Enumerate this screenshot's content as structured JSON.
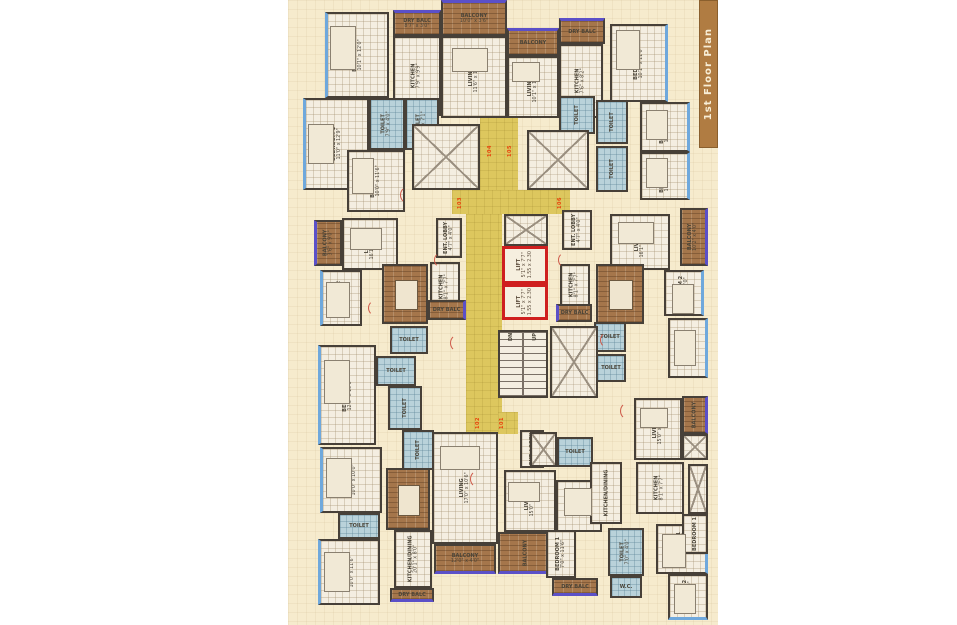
{
  "banner": {
    "title": "1st Floor Plan"
  },
  "colors": {
    "window": "#6fa8dc",
    "balcony_edge": "#5b50c8",
    "wall": "#474038",
    "lift_outline": "#cf1f1f",
    "unit_number": "#e8430c",
    "corridor": "#ddc75e",
    "plan_background": "#f6ebcd"
  },
  "areas": [
    {
      "kind": "yellow",
      "name": "corridor",
      "x": 480,
      "y": 114,
      "w": 38,
      "h": 84
    },
    {
      "kind": "yellow",
      "name": "corridor",
      "x": 452,
      "y": 190,
      "w": 118,
      "h": 24
    },
    {
      "kind": "yellow",
      "name": "corridor",
      "x": 466,
      "y": 214,
      "w": 36,
      "h": 218
    },
    {
      "kind": "yellow",
      "name": "corridor",
      "x": 498,
      "y": 412,
      "w": 20,
      "h": 22
    },
    {
      "kind": "room",
      "label": "BEDROOM 2",
      "dims": "10'1\" x 12'0\"",
      "rot": 1,
      "x": 325,
      "y": 12,
      "w": 64,
      "h": 86,
      "win": "l"
    },
    {
      "kind": "balcony",
      "label": "DRY BALC",
      "dims": "8'7\" x 3'0\"",
      "x": 393,
      "y": 10,
      "w": 48,
      "h": 26,
      "win": "t"
    },
    {
      "kind": "room",
      "label": "KITCHEN",
      "dims": "7'9\" x 9'9\"",
      "rot": 1,
      "x": 393,
      "y": 36,
      "w": 48,
      "h": 80
    },
    {
      "kind": "room",
      "label": "BEDROOM 1",
      "dims": "11'0\" x 12'9\"",
      "rot": 1,
      "x": 303,
      "y": 98,
      "w": 66,
      "h": 92,
      "win": "l"
    },
    {
      "kind": "toilet",
      "label": "TOILET",
      "dims": "7'9\" x 4'0\"",
      "rot": 1,
      "x": 369,
      "y": 98,
      "w": 36,
      "h": 52
    },
    {
      "kind": "toilet",
      "label": "TOILET",
      "dims": "4'0\" x 7'1\"",
      "rot": 1,
      "x": 405,
      "y": 98,
      "w": 34,
      "h": 52
    },
    {
      "kind": "room",
      "label": "BEDROOM 3",
      "dims": "10'0\" x 11'6\"",
      "rot": 1,
      "x": 347,
      "y": 150,
      "w": 58,
      "h": 62
    },
    {
      "kind": "balcony",
      "label": "BALCONY",
      "dims": "10'0\" x 3'6\"",
      "x": 441,
      "y": 0,
      "w": 66,
      "h": 36,
      "win": "t"
    },
    {
      "kind": "room",
      "label": "LIVING",
      "dims": "11'6\" x 11'0\"",
      "rot": 1,
      "x": 441,
      "y": 36,
      "w": 66,
      "h": 82
    },
    {
      "kind": "balcony",
      "label": "BALCONY",
      "x": 507,
      "y": 28,
      "w": 52,
      "h": 28,
      "win": "t"
    },
    {
      "kind": "room",
      "label": "LIVING",
      "dims": "10'1\" x 12'6\"",
      "rot": 1,
      "x": 507,
      "y": 56,
      "w": 52,
      "h": 62
    },
    {
      "kind": "balcony",
      "label": "DRY BALC",
      "x": 559,
      "y": 18,
      "w": 46,
      "h": 26,
      "win": "t"
    },
    {
      "kind": "room",
      "label": "KITCHEN",
      "dims": "7'6\" x 8'2\"",
      "rot": 1,
      "x": 559,
      "y": 44,
      "w": 44,
      "h": 74
    },
    {
      "kind": "room",
      "label": "BEDROOM 2",
      "dims": "10'1\" x 11'0\"",
      "rot": 1,
      "x": 610,
      "y": 24,
      "w": 58,
      "h": 78,
      "win": "r"
    },
    {
      "kind": "toilet",
      "label": "TOILET",
      "rot": 1,
      "x": 559,
      "y": 96,
      "w": 36,
      "h": 38
    },
    {
      "kind": "toilet",
      "label": "TOILET",
      "rot": 1,
      "x": 596,
      "y": 100,
      "w": 32,
      "h": 44
    },
    {
      "kind": "room",
      "label": "BEDROOM 1",
      "dims": "11'0\" x 10'1\"",
      "rot": 1,
      "x": 640,
      "y": 102,
      "w": 50,
      "h": 50,
      "win": "r"
    },
    {
      "kind": "toilet",
      "label": "TOILET",
      "rot": 1,
      "x": 596,
      "y": 146,
      "w": 32,
      "h": 46
    },
    {
      "kind": "room",
      "label": "BEDROOM 1",
      "dims": "11'6\" x 10'1\"",
      "rot": 1,
      "x": 640,
      "y": 152,
      "w": 50,
      "h": 48,
      "win": "r"
    },
    {
      "kind": "room",
      "label": "ENT. LOBBY",
      "dims": "4'7\" x 4'0\"",
      "rot": 1,
      "x": 562,
      "y": 210,
      "w": 30,
      "h": 40
    },
    {
      "kind": "room",
      "label": "LIVING",
      "dims": "16'1\" x 10'6\"",
      "rot": 1,
      "x": 610,
      "y": 214,
      "w": 60,
      "h": 56
    },
    {
      "kind": "balcony",
      "label": "BALCONY",
      "dims": "10'2\" x 4'0\"",
      "rot": 1,
      "x": 680,
      "y": 208,
      "w": 28,
      "h": 58,
      "win": "r"
    },
    {
      "kind": "room",
      "label": "KITCHEN",
      "dims": "8'1\" x 7'7\"",
      "rot": 1,
      "x": 560,
      "y": 264,
      "w": 30,
      "h": 42
    },
    {
      "kind": "dining",
      "label": "DINING",
      "dims": "8'0\" x 8'0\"",
      "rot": 1,
      "x": 596,
      "y": 264,
      "w": 48,
      "h": 60
    },
    {
      "kind": "room",
      "label": "BEDROOM 2",
      "dims": "10'1\" x 10'0\"",
      "rot": 1,
      "x": 664,
      "y": 270,
      "w": 40,
      "h": 46,
      "win": "r"
    },
    {
      "kind": "balcony",
      "label": "DRY BALC",
      "x": 556,
      "y": 304,
      "w": 36,
      "h": 18,
      "win": "l"
    },
    {
      "kind": "toilet",
      "label": "TOILET",
      "x": 594,
      "y": 322,
      "w": 32,
      "h": 30
    },
    {
      "kind": "room",
      "label": "BEDROOM 2",
      "dims": "11'6\" x 10'6\"",
      "rot": 1,
      "x": 668,
      "y": 318,
      "w": 40,
      "h": 60,
      "win": "r"
    },
    {
      "kind": "toilet",
      "label": "TOILET",
      "x": 596,
      "y": 354,
      "w": 30,
      "h": 28
    },
    {
      "kind": "balcony",
      "label": "BALCONY",
      "dims": "3'6\" x 9'0\"",
      "rot": 1,
      "x": 314,
      "y": 220,
      "w": 28,
      "h": 46,
      "win": "l"
    },
    {
      "kind": "room",
      "label": "LIVING",
      "dims": "16'1\" x 10'6\"",
      "rot": 1,
      "x": 342,
      "y": 218,
      "w": 56,
      "h": 52
    },
    {
      "kind": "room",
      "label": "ENT. LOBBY",
      "dims": "4'7\" x 4'0\"",
      "rot": 1,
      "x": 436,
      "y": 218,
      "w": 26,
      "h": 40
    },
    {
      "kind": "room",
      "label": "KITCHEN",
      "dims": "8'1\" x 7'7\"",
      "rot": 1,
      "x": 430,
      "y": 262,
      "w": 30,
      "h": 50
    },
    {
      "kind": "dining",
      "label": "DINING",
      "dims": "8'0\" x 8'0\"",
      "rot": 1,
      "x": 382,
      "y": 264,
      "w": 46,
      "h": 60
    },
    {
      "kind": "room",
      "label": "BEDROOM 2",
      "dims": "10'1\" x 10'0\"",
      "rot": 1,
      "x": 320,
      "y": 270,
      "w": 42,
      "h": 56,
      "win": "l"
    },
    {
      "kind": "balcony",
      "label": "DRY BALC",
      "x": 428,
      "y": 300,
      "w": 38,
      "h": 20,
      "win": "r"
    },
    {
      "kind": "toilet",
      "label": "TOILET",
      "x": 390,
      "y": 326,
      "w": 38,
      "h": 28
    },
    {
      "kind": "toilet",
      "label": "TOILET",
      "x": 376,
      "y": 356,
      "w": 40,
      "h": 30
    },
    {
      "kind": "room",
      "label": "BEDROOM 1",
      "dims": "12'0\" x 10'6\"",
      "rot": 1,
      "x": 318,
      "y": 345,
      "w": 58,
      "h": 100,
      "win": "l"
    },
    {
      "kind": "toilet",
      "label": "TOILET",
      "rot": 1,
      "x": 388,
      "y": 386,
      "w": 34,
      "h": 44
    },
    {
      "kind": "toilet",
      "label": "TOILET",
      "rot": 1,
      "x": 402,
      "y": 430,
      "w": 32,
      "h": 40
    },
    {
      "kind": "room",
      "label": "BEDROOM 2",
      "dims": "10'0\" x 10'0\"",
      "rot": 1,
      "x": 320,
      "y": 447,
      "w": 62,
      "h": 66,
      "win": "l"
    },
    {
      "kind": "toilet",
      "label": "TOILET",
      "x": 338,
      "y": 513,
      "w": 42,
      "h": 26
    },
    {
      "kind": "room",
      "label": "BEDROOM 1",
      "dims": "10'0\" x 11'6\"",
      "rot": 1,
      "x": 318,
      "y": 539,
      "w": 62,
      "h": 66,
      "win": "l"
    },
    {
      "kind": "dining",
      "label": "DINING",
      "rot": 1,
      "x": 386,
      "y": 468,
      "w": 44,
      "h": 62
    },
    {
      "kind": "room",
      "label": "KITCHEN/DINING",
      "dims": "20'1\" x 8'0\"",
      "rot": 1,
      "x": 394,
      "y": 530,
      "w": 38,
      "h": 58
    },
    {
      "kind": "balcony",
      "label": "DRY BALC",
      "x": 390,
      "y": 588,
      "w": 44,
      "h": 14,
      "win": "b"
    },
    {
      "kind": "room",
      "label": "LIVING",
      "dims": "17'0\" x 10'6\"",
      "rot": 1,
      "x": 432,
      "y": 432,
      "w": 66,
      "h": 112
    },
    {
      "kind": "balcony",
      "label": "BALCONY",
      "dims": "12'0\" x 4'0\"",
      "x": 434,
      "y": 544,
      "w": 62,
      "h": 30,
      "win": "b"
    },
    {
      "kind": "room",
      "label": "ENT. LOBBY",
      "rot": 1,
      "x": 520,
      "y": 430,
      "w": 24,
      "h": 38
    },
    {
      "kind": "shaft",
      "name": "duct-shaft",
      "x": 530,
      "y": 432,
      "w": 27,
      "h": 35
    },
    {
      "kind": "toilet",
      "label": "TOILET",
      "x": 557,
      "y": 437,
      "w": 36,
      "h": 30
    },
    {
      "kind": "room",
      "label": "LIVING",
      "dims": "15'0\" x 10'1\"",
      "rot": 1,
      "x": 504,
      "y": 470,
      "w": 52,
      "h": 62
    },
    {
      "kind": "balcony",
      "label": "BALCONY",
      "rot": 1,
      "x": 498,
      "y": 532,
      "w": 54,
      "h": 42,
      "win": "b"
    },
    {
      "kind": "room",
      "label": "DINING",
      "x": 556,
      "y": 480,
      "w": 46,
      "h": 52
    },
    {
      "kind": "room",
      "label": "BEDROOM 1",
      "dims": "7'0\" x 11'6\"",
      "rot": 1,
      "x": 546,
      "y": 530,
      "w": 30,
      "h": 48
    },
    {
      "kind": "balcony",
      "label": "DRY BALC",
      "x": 552,
      "y": 578,
      "w": 46,
      "h": 18,
      "win": "b"
    },
    {
      "kind": "toilet",
      "label": "TOILET",
      "dims": "7'0\" x 4'0\"",
      "rot": 1,
      "x": 608,
      "y": 528,
      "w": 36,
      "h": 48
    },
    {
      "kind": "toilet",
      "label": "W.C.",
      "x": 610,
      "y": 576,
      "w": 32,
      "h": 22
    },
    {
      "kind": "room",
      "label": "BEDROOM 1",
      "dims": "11'6\" x 10'1\"",
      "rot": 1,
      "x": 656,
      "y": 524,
      "w": 52,
      "h": 50,
      "win": "r"
    },
    {
      "kind": "room",
      "label": "BEDROOM 2",
      "dims": "10'1\" x 11'0\"",
      "rot": 1,
      "x": 668,
      "y": 574,
      "w": 40,
      "h": 46,
      "win": "b"
    },
    {
      "kind": "room",
      "label": "LIVING",
      "dims": "15'0\" x 10'1\"",
      "rot": 1,
      "x": 634,
      "y": 398,
      "w": 48,
      "h": 62
    },
    {
      "kind": "balcony",
      "label": "BALCONY",
      "rot": 1,
      "x": 682,
      "y": 396,
      "w": 26,
      "h": 38,
      "win": "r"
    },
    {
      "kind": "shaft",
      "name": "duct-shaft",
      "x": 682,
      "y": 434,
      "w": 26,
      "h": 26
    },
    {
      "kind": "room",
      "label": "KITCHEN",
      "dims": "8'1\" x 7'7\"",
      "rot": 1,
      "x": 636,
      "y": 462,
      "w": 48,
      "h": 52
    },
    {
      "kind": "shaft",
      "name": "duct-shaft",
      "x": 688,
      "y": 464,
      "w": 20,
      "h": 50
    },
    {
      "kind": "room",
      "label": "KITCHEN/DINING",
      "rot": 1,
      "x": 590,
      "y": 462,
      "w": 32,
      "h": 62
    },
    {
      "kind": "room",
      "label": "BEDROOM 1",
      "rot": 1,
      "x": 682,
      "y": 514,
      "w": 26,
      "h": 40
    },
    {
      "kind": "shaft",
      "name": "lobby-shaft",
      "x": 412,
      "y": 124,
      "w": 68,
      "h": 66
    },
    {
      "kind": "shaft",
      "name": "lobby-shaft",
      "x": 527,
      "y": 130,
      "w": 62,
      "h": 60
    },
    {
      "kind": "shaft",
      "name": "lift-lobby-shaft",
      "x": 504,
      "y": 214,
      "w": 44,
      "h": 32
    },
    {
      "kind": "lift",
      "name": "lift-1",
      "label": "LIFT",
      "dims": "5'1\" x 7'7\"",
      "dims2": "1.55 x 2.30",
      "rot": 1,
      "x": 502,
      "y": 246,
      "w": 46,
      "h": 38
    },
    {
      "kind": "lift",
      "name": "lift-2",
      "label": "LIFT",
      "dims": "5'1\" x 7'7\"",
      "dims2": "1.55 x 2.30",
      "rot": 1,
      "x": 502,
      "y": 284,
      "w": 46,
      "h": 36
    },
    {
      "kind": "stair",
      "name": "staircase",
      "x": 498,
      "y": 330,
      "w": 50,
      "h": 68
    },
    {
      "kind": "shaft",
      "name": "stair-shaft",
      "x": 550,
      "y": 326,
      "w": 48,
      "h": 72
    },
    {
      "kind": "tinytext",
      "name": "stair-dn-label",
      "label": "DN",
      "x": 504,
      "y": 331,
      "w": 14,
      "h": 12
    },
    {
      "kind": "tinytext",
      "name": "stair-up-label",
      "label": "UP",
      "x": 528,
      "y": 331,
      "w": 14,
      "h": 12
    },
    {
      "kind": "unit",
      "name": "unit-number-104",
      "label": "104",
      "x": 482,
      "y": 138,
      "w": 16,
      "h": 26
    },
    {
      "kind": "unit",
      "name": "unit-number-105",
      "label": "105",
      "x": 502,
      "y": 138,
      "w": 16,
      "h": 26
    },
    {
      "kind": "unit",
      "name": "unit-number-103",
      "label": "103",
      "x": 452,
      "y": 190,
      "w": 16,
      "h": 26
    },
    {
      "kind": "unit",
      "name": "unit-number-106",
      "label": "106",
      "x": 552,
      "y": 190,
      "w": 16,
      "h": 26
    },
    {
      "kind": "unit",
      "name": "unit-number-102",
      "label": "102",
      "x": 470,
      "y": 410,
      "w": 16,
      "h": 26
    },
    {
      "kind": "unit",
      "name": "unit-number-101",
      "label": "101",
      "x": 494,
      "y": 410,
      "w": 16,
      "h": 26
    },
    {
      "kind": "furn",
      "name": "bed",
      "x": 308,
      "y": 124,
      "w": 26,
      "h": 40
    },
    {
      "kind": "furn",
      "name": "bed",
      "x": 330,
      "y": 26,
      "w": 26,
      "h": 44
    },
    {
      "kind": "furn",
      "name": "bed",
      "x": 352,
      "y": 158,
      "w": 22,
      "h": 36
    },
    {
      "kind": "furn",
      "name": "bed",
      "x": 646,
      "y": 110,
      "w": 22,
      "h": 30
    },
    {
      "kind": "furn",
      "name": "bed",
      "x": 646,
      "y": 158,
      "w": 22,
      "h": 30
    },
    {
      "kind": "furn",
      "name": "bed",
      "x": 616,
      "y": 30,
      "w": 24,
      "h": 40
    },
    {
      "kind": "furn",
      "name": "bed",
      "x": 326,
      "y": 282,
      "w": 24,
      "h": 36
    },
    {
      "kind": "furn",
      "name": "bed",
      "x": 324,
      "y": 360,
      "w": 26,
      "h": 44
    },
    {
      "kind": "furn",
      "name": "bed",
      "x": 326,
      "y": 458,
      "w": 26,
      "h": 40
    },
    {
      "kind": "furn",
      "name": "bed",
      "x": 324,
      "y": 552,
      "w": 26,
      "h": 40
    },
    {
      "kind": "furn",
      "name": "bed",
      "x": 672,
      "y": 284,
      "w": 22,
      "h": 30
    },
    {
      "kind": "furn",
      "name": "bed",
      "x": 674,
      "y": 330,
      "w": 22,
      "h": 36
    },
    {
      "kind": "furn",
      "name": "bed",
      "x": 662,
      "y": 534,
      "w": 24,
      "h": 34
    },
    {
      "kind": "furn",
      "name": "bed",
      "x": 674,
      "y": 584,
      "w": 22,
      "h": 30
    },
    {
      "kind": "furn",
      "name": "sofa",
      "x": 452,
      "y": 48,
      "w": 36,
      "h": 24
    },
    {
      "kind": "furn",
      "name": "sofa",
      "x": 512,
      "y": 62,
      "w": 28,
      "h": 20
    },
    {
      "kind": "furn",
      "name": "sofa",
      "x": 618,
      "y": 222,
      "w": 36,
      "h": 22
    },
    {
      "kind": "furn",
      "name": "sofa",
      "x": 350,
      "y": 228,
      "w": 32,
      "h": 22
    },
    {
      "kind": "furn",
      "name": "sofa",
      "x": 440,
      "y": 446,
      "w": 40,
      "h": 24
    },
    {
      "kind": "furn",
      "name": "sofa",
      "x": 508,
      "y": 482,
      "w": 32,
      "h": 20
    },
    {
      "kind": "furn",
      "name": "sofa",
      "x": 640,
      "y": 408,
      "w": 28,
      "h": 20
    },
    {
      "kind": "furn",
      "name": "dining-table",
      "x": 564,
      "y": 488,
      "w": 28,
      "h": 28
    },
    {
      "kind": "door",
      "name": "door-arc",
      "x": 400,
      "y": 186,
      "w": 18,
      "h": 18
    },
    {
      "kind": "door",
      "name": "door-arc",
      "x": 434,
      "y": 252,
      "w": 16,
      "h": 16
    },
    {
      "kind": "door",
      "name": "door-arc",
      "x": 558,
      "y": 252,
      "w": 16,
      "h": 16
    },
    {
      "kind": "door",
      "name": "door-arc",
      "x": 450,
      "y": 334,
      "w": 18,
      "h": 18
    },
    {
      "kind": "door",
      "name": "door-arc",
      "x": 600,
      "y": 332,
      "w": 16,
      "h": 16
    },
    {
      "kind": "door",
      "name": "door-arc",
      "x": 368,
      "y": 300,
      "w": 16,
      "h": 16
    },
    {
      "kind": "door",
      "name": "door-arc",
      "x": 620,
      "y": 402,
      "w": 18,
      "h": 18
    },
    {
      "kind": "door",
      "name": "door-arc",
      "x": 470,
      "y": 470,
      "w": 18,
      "h": 18
    }
  ]
}
